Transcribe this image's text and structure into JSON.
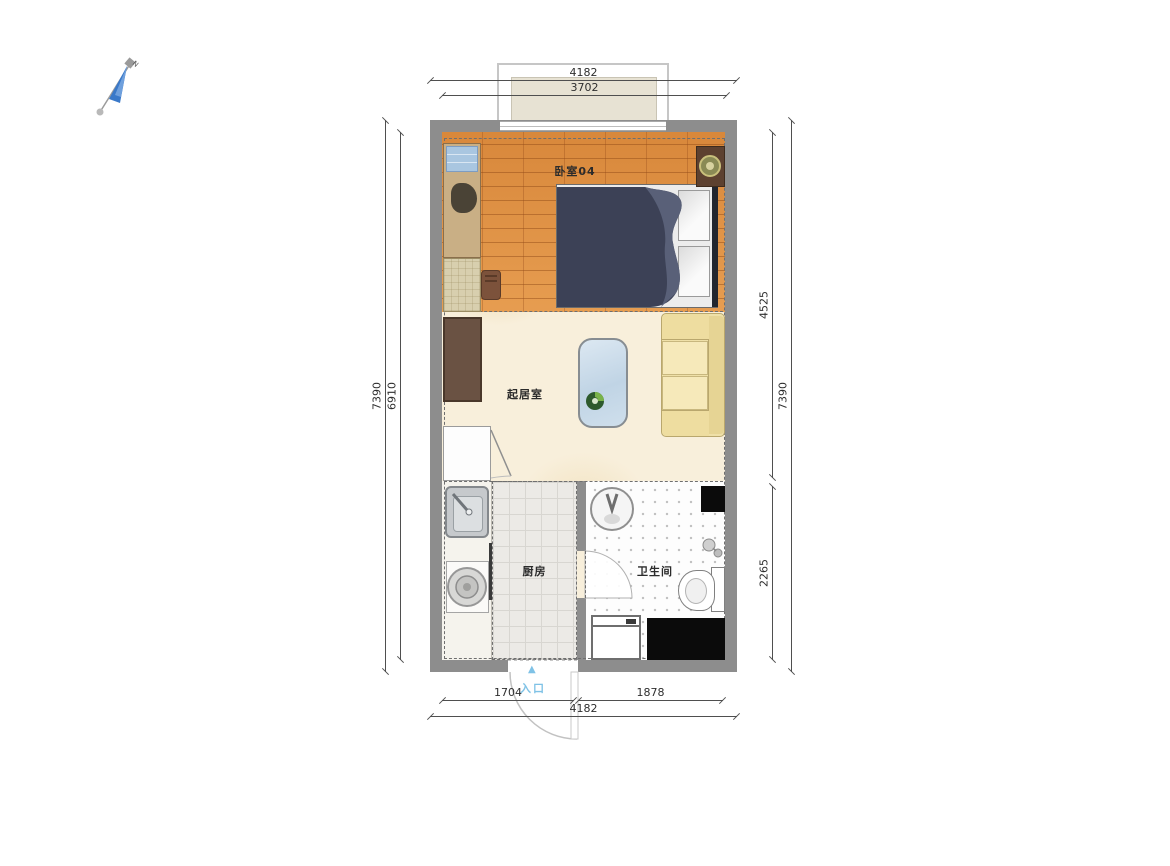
{
  "compass": {
    "label": "N"
  },
  "rooms": {
    "bedroom": {
      "label": "卧室04"
    },
    "living": {
      "label": "起居室"
    },
    "kitchen": {
      "label": "厨房"
    },
    "bathroom": {
      "label": "卫生间"
    }
  },
  "entrance": {
    "label": "入口",
    "arrow": "▲"
  },
  "dimensions": {
    "top": [
      {
        "value": "4182"
      },
      {
        "value": "3702"
      }
    ],
    "left": [
      {
        "value": "7390"
      },
      {
        "value": "6910"
      }
    ],
    "right": [
      {
        "value": "4525"
      },
      {
        "value": "7390"
      },
      {
        "value": "2265"
      }
    ],
    "bottom": [
      {
        "value": "1704"
      },
      {
        "value": "1878"
      },
      {
        "value": "4182"
      }
    ]
  },
  "colors": {
    "wall": "#8d8d8d",
    "wood_floor": "#dd8e3f",
    "living_floor": "#f8efdb",
    "kitchen_floor": "#eceae6",
    "bathroom_floor": "#fdfdfd",
    "bed": "#3c4156",
    "sofa": "#efe0a8",
    "coffee_table": "#c6d9ea",
    "entrance_blue": "#7fc2e6",
    "black_fixture": "#0b0b0b"
  }
}
